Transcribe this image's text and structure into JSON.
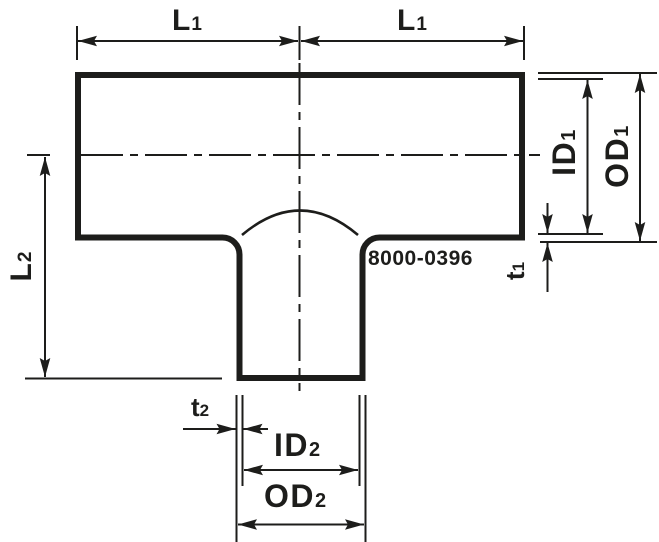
{
  "diagram": {
    "part_number": "8000-0396",
    "dimension_labels": {
      "l1_left": {
        "text": "L",
        "sub": "1"
      },
      "l1_right": {
        "text": "L",
        "sub": "1"
      },
      "l2": {
        "text": "L",
        "sub": "2"
      },
      "id1": {
        "text": "ID",
        "sub": "1"
      },
      "od1": {
        "text": "OD",
        "sub": "1"
      },
      "t1": {
        "text": "t",
        "sub": "1"
      },
      "t2": {
        "text": "t",
        "sub": "2"
      },
      "id2": {
        "text": "ID",
        "sub": "2"
      },
      "od2": {
        "text": "OD",
        "sub": "2"
      }
    },
    "colors": {
      "line_color": "#1d1d1b",
      "background": "#ffffff"
    }
  }
}
